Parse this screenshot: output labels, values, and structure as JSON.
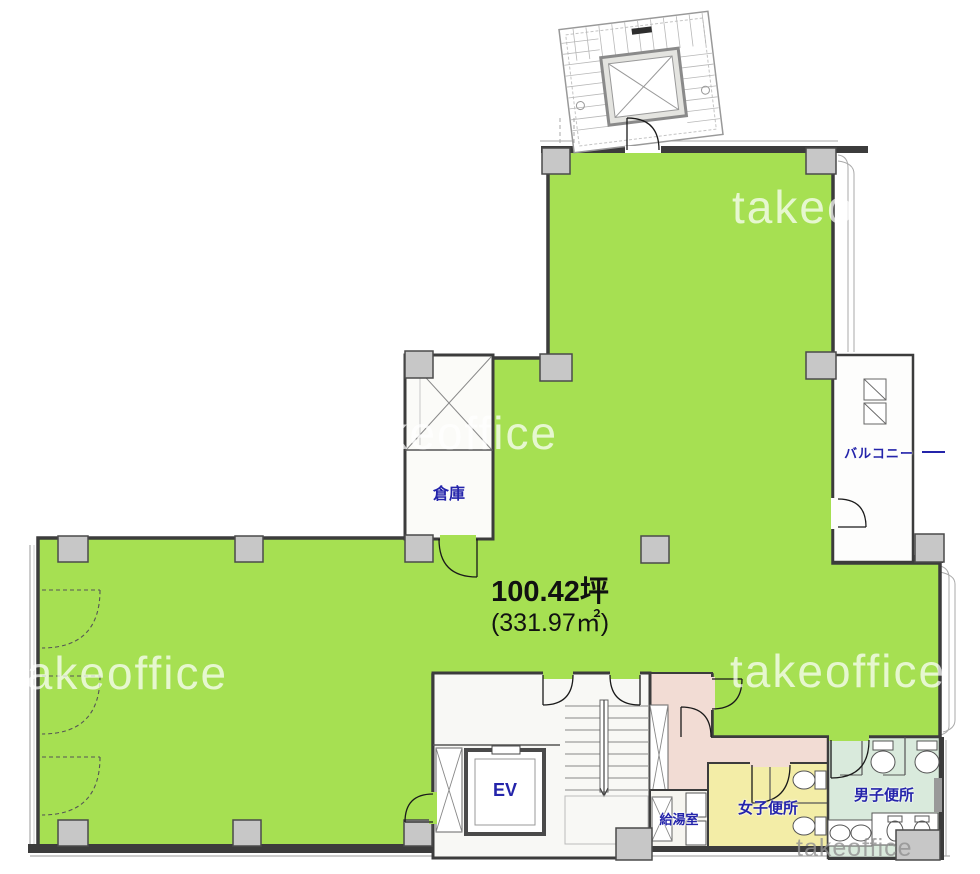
{
  "floorplan": {
    "area_tsubo": "100.42坪",
    "area_sqm": "(331.97㎡)",
    "rooms": {
      "warehouse": "倉庫",
      "balcony": "バルコニー",
      "elevator": "EV",
      "kitchenette": "給湯室",
      "womens_toilet": "女子便所",
      "mens_toilet": "男子便所"
    },
    "watermark": "takeoffice",
    "colors": {
      "office_green": "#a6e052",
      "corridor_pink": "#f2dcd4",
      "womens_yellow": "#f3eda7",
      "mens_mint": "#d9eadc",
      "label_blue": "#2424aa",
      "wall_dark": "#3c3c3c",
      "column_gray": "#c7c7c7"
    }
  }
}
